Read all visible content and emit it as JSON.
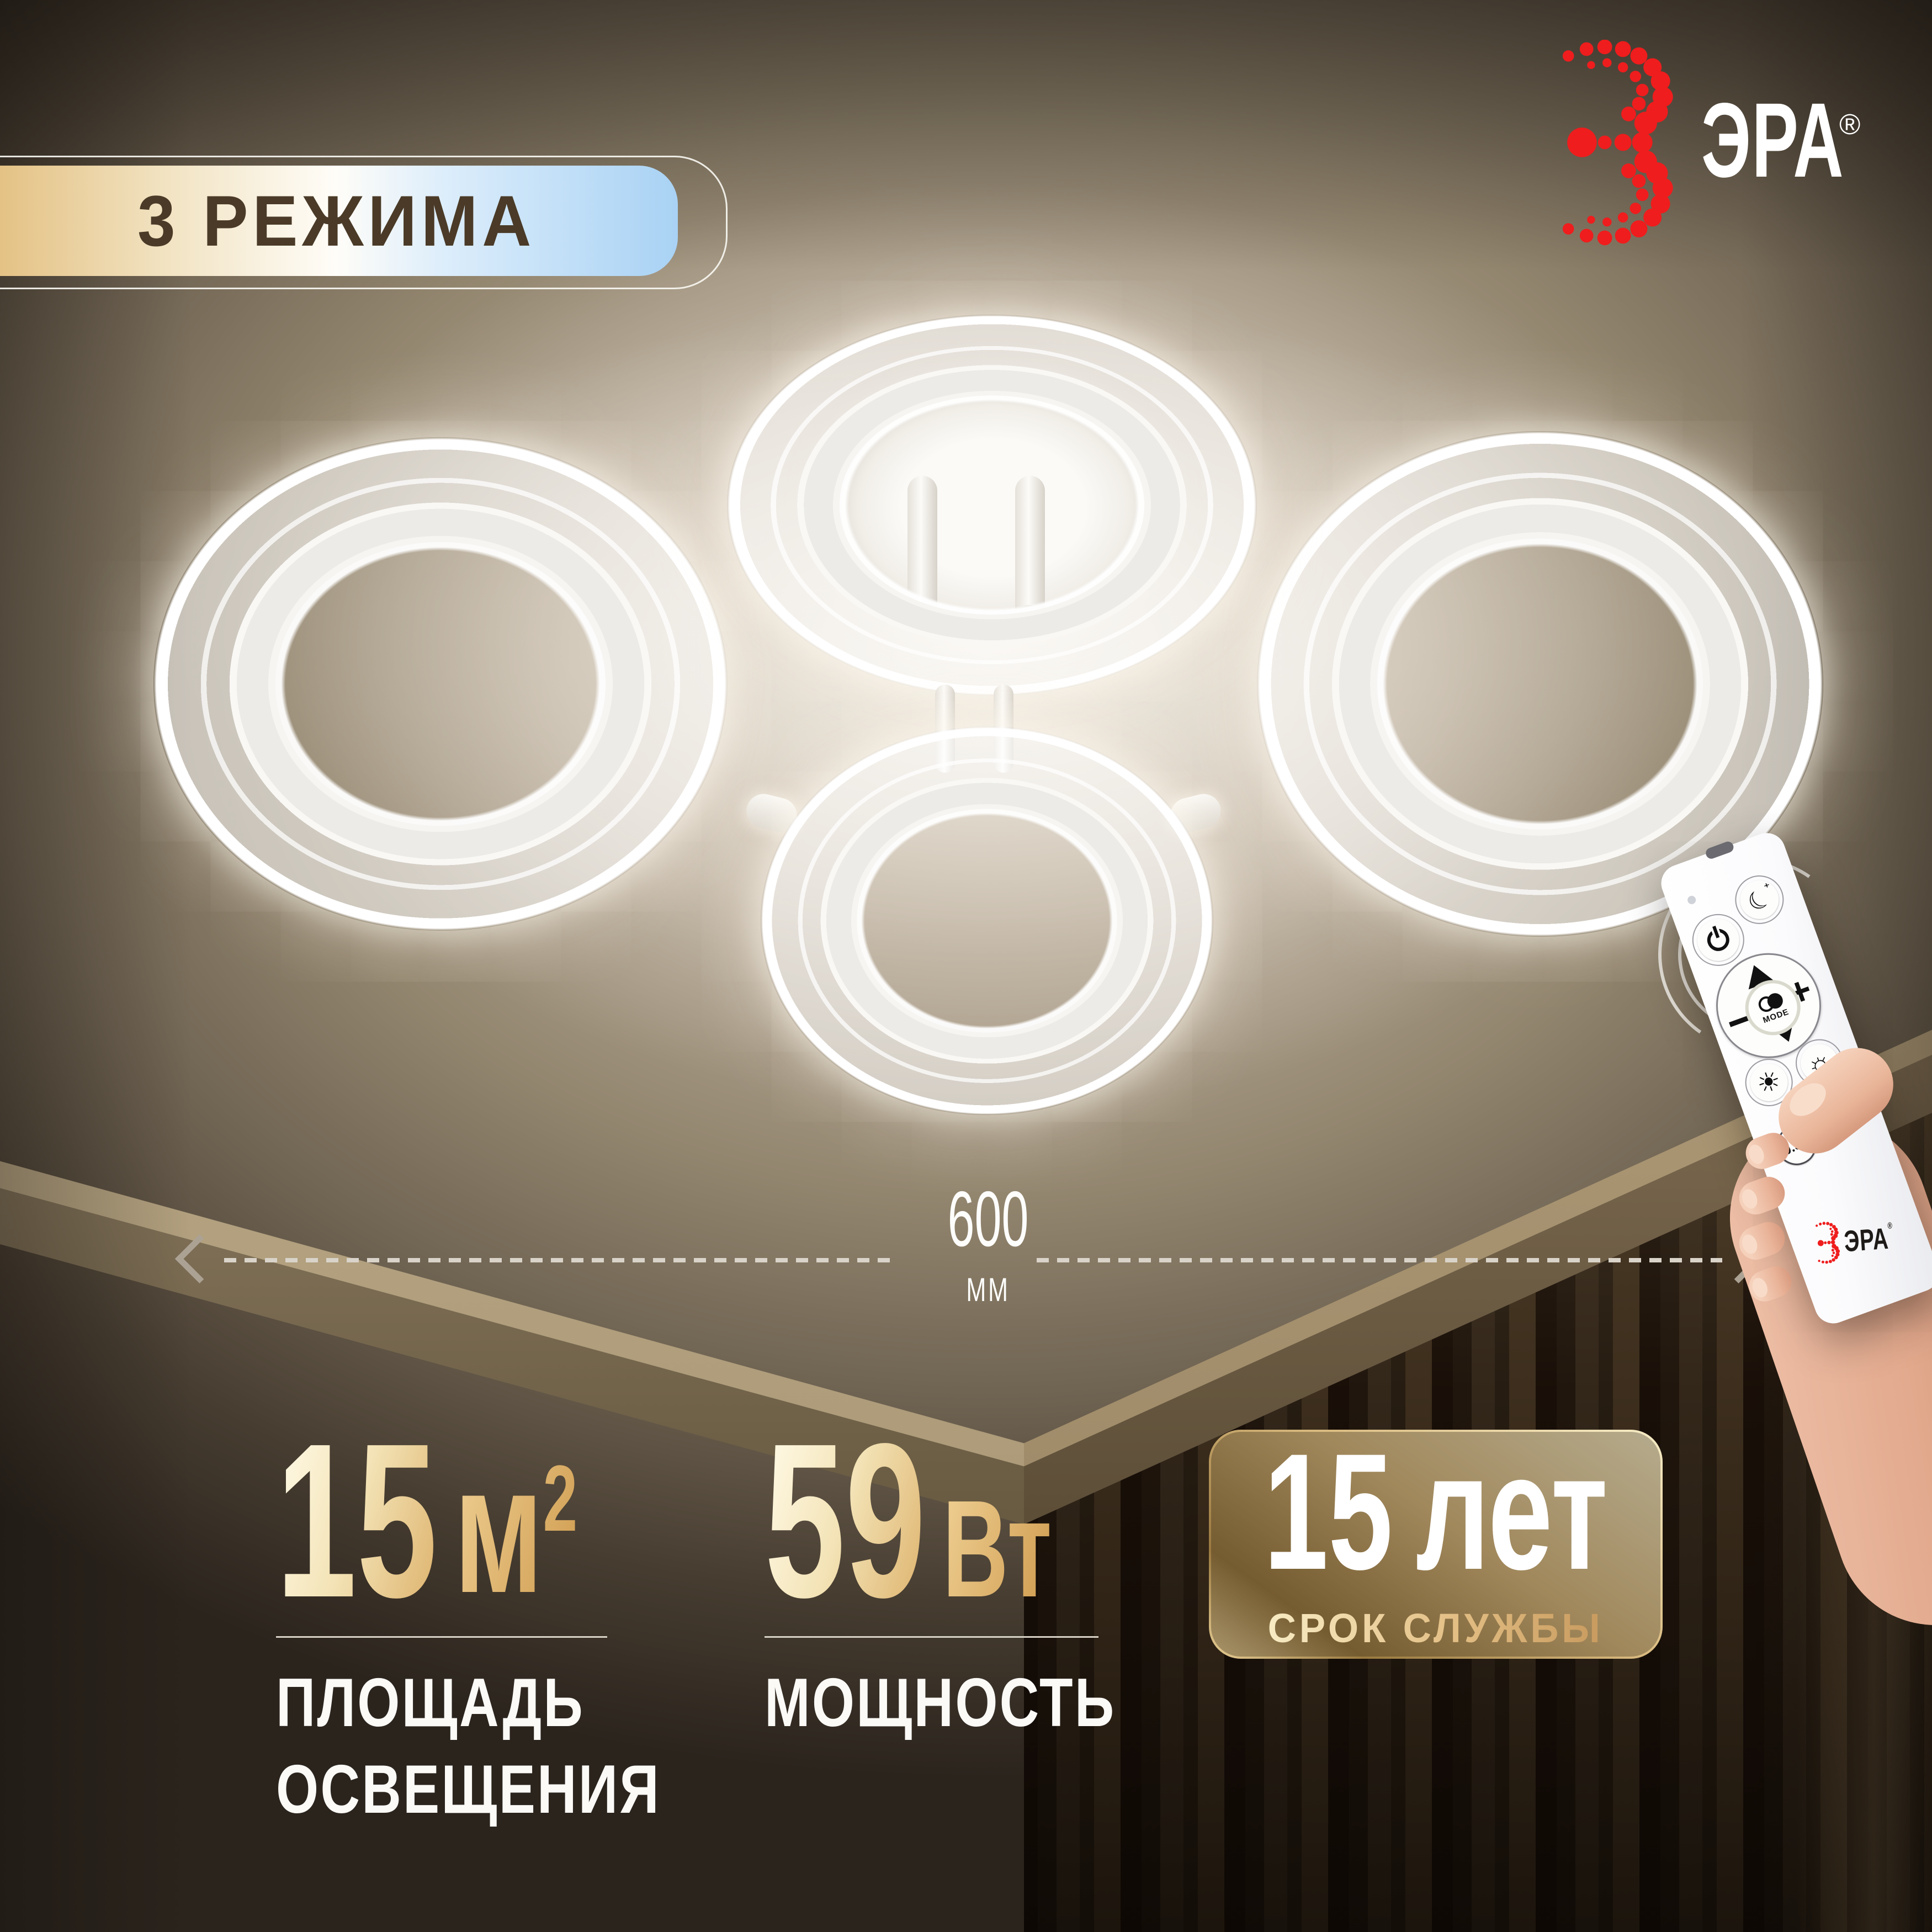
{
  "badge": {
    "label": "3 РЕЖИМА"
  },
  "brand": {
    "name": "ЭРА",
    "registered_mark": "®"
  },
  "dimension": {
    "value": "600",
    "unit": "ММ"
  },
  "specs": [
    {
      "value": "15",
      "unit": "м",
      "unit_sup": "2",
      "label_line1": "ПЛОЩАДЬ",
      "label_line2": "ОСВЕЩЕНИЯ"
    },
    {
      "value": "59",
      "unit": "Вт",
      "label": "МОЩНОСТЬ"
    },
    {
      "value": "15",
      "unit": "лет",
      "label": "СРОК СЛУЖБЫ"
    }
  ],
  "remote": {
    "mode_label": "MODE",
    "timer_label": "0.5H",
    "brand": "ЭРА",
    "registered_mark": "®",
    "icons": {
      "up": "▲",
      "down": "▼",
      "minus": "−",
      "plus": "+",
      "night_mode": "☾",
      "night_mode_sparkle": "⁺",
      "brightness": "☼",
      "night_light": "☀"
    }
  },
  "colors": {
    "brand_red": "#ef1d1d",
    "badge_gold": "#e4c183",
    "badge_blue": "#a9d2f4",
    "accent_gold": "#d2a055",
    "text_dark": "#4a3a27",
    "text_white": "#fdfdfb",
    "ceiling_taupe": "#93866f"
  }
}
